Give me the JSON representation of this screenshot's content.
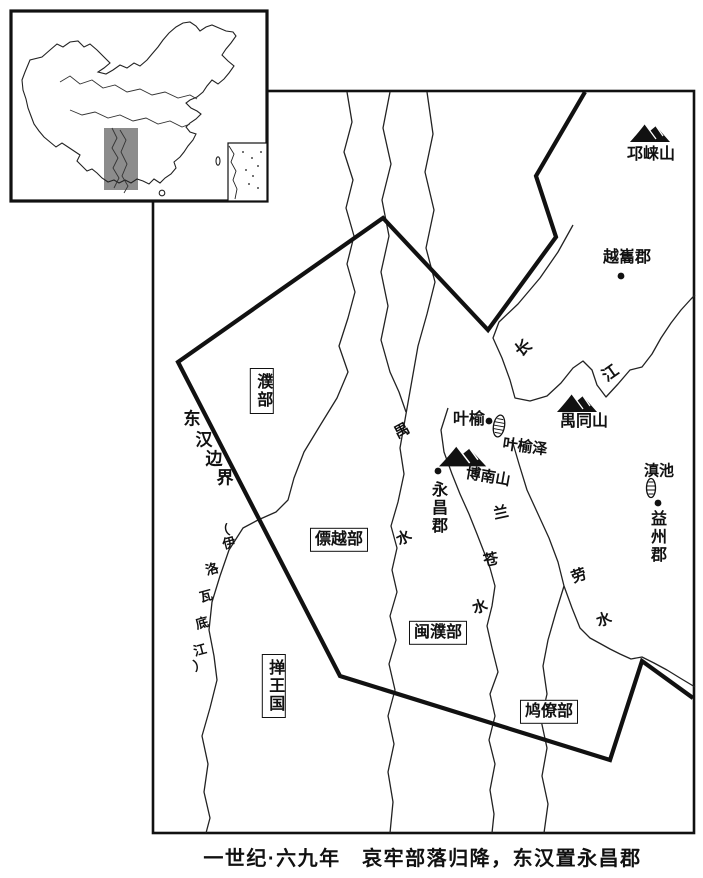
{
  "caption": "一世纪·六九年　哀牢部落归降，东汉置永昌郡",
  "border_label": [
    "东",
    "汉",
    "边",
    "界"
  ],
  "mountains": {
    "qionglai": "邛崃山",
    "yutong": "禺同山",
    "bonan": "博南山"
  },
  "settlements": {
    "yuexi": "越巂郡",
    "yeyu": "叶榆",
    "yongchang": "永昌郡",
    "yizhou": "益州郡"
  },
  "lakes": {
    "yeyuze": "叶榆泽",
    "dianchi": "滇池"
  },
  "tribes": {
    "pu": "濮部",
    "piaoyue": "僄越部",
    "minpu": "闽濮部",
    "jiuliao": "鸠僚部",
    "shan": "掸王国"
  },
  "rivers": {
    "changjiang": [
      "长",
      "江"
    ],
    "yushui": [
      "禺",
      "水"
    ],
    "lancangshui": [
      "兰",
      "苍",
      "水"
    ],
    "laoshui": [
      "劳",
      "水"
    ],
    "irrawaddy": [
      "（",
      "伊",
      "洛",
      "瓦",
      "底",
      "江",
      "）"
    ]
  },
  "colors": {
    "highlight": "#8c8c8c",
    "ink": "#111111"
  }
}
